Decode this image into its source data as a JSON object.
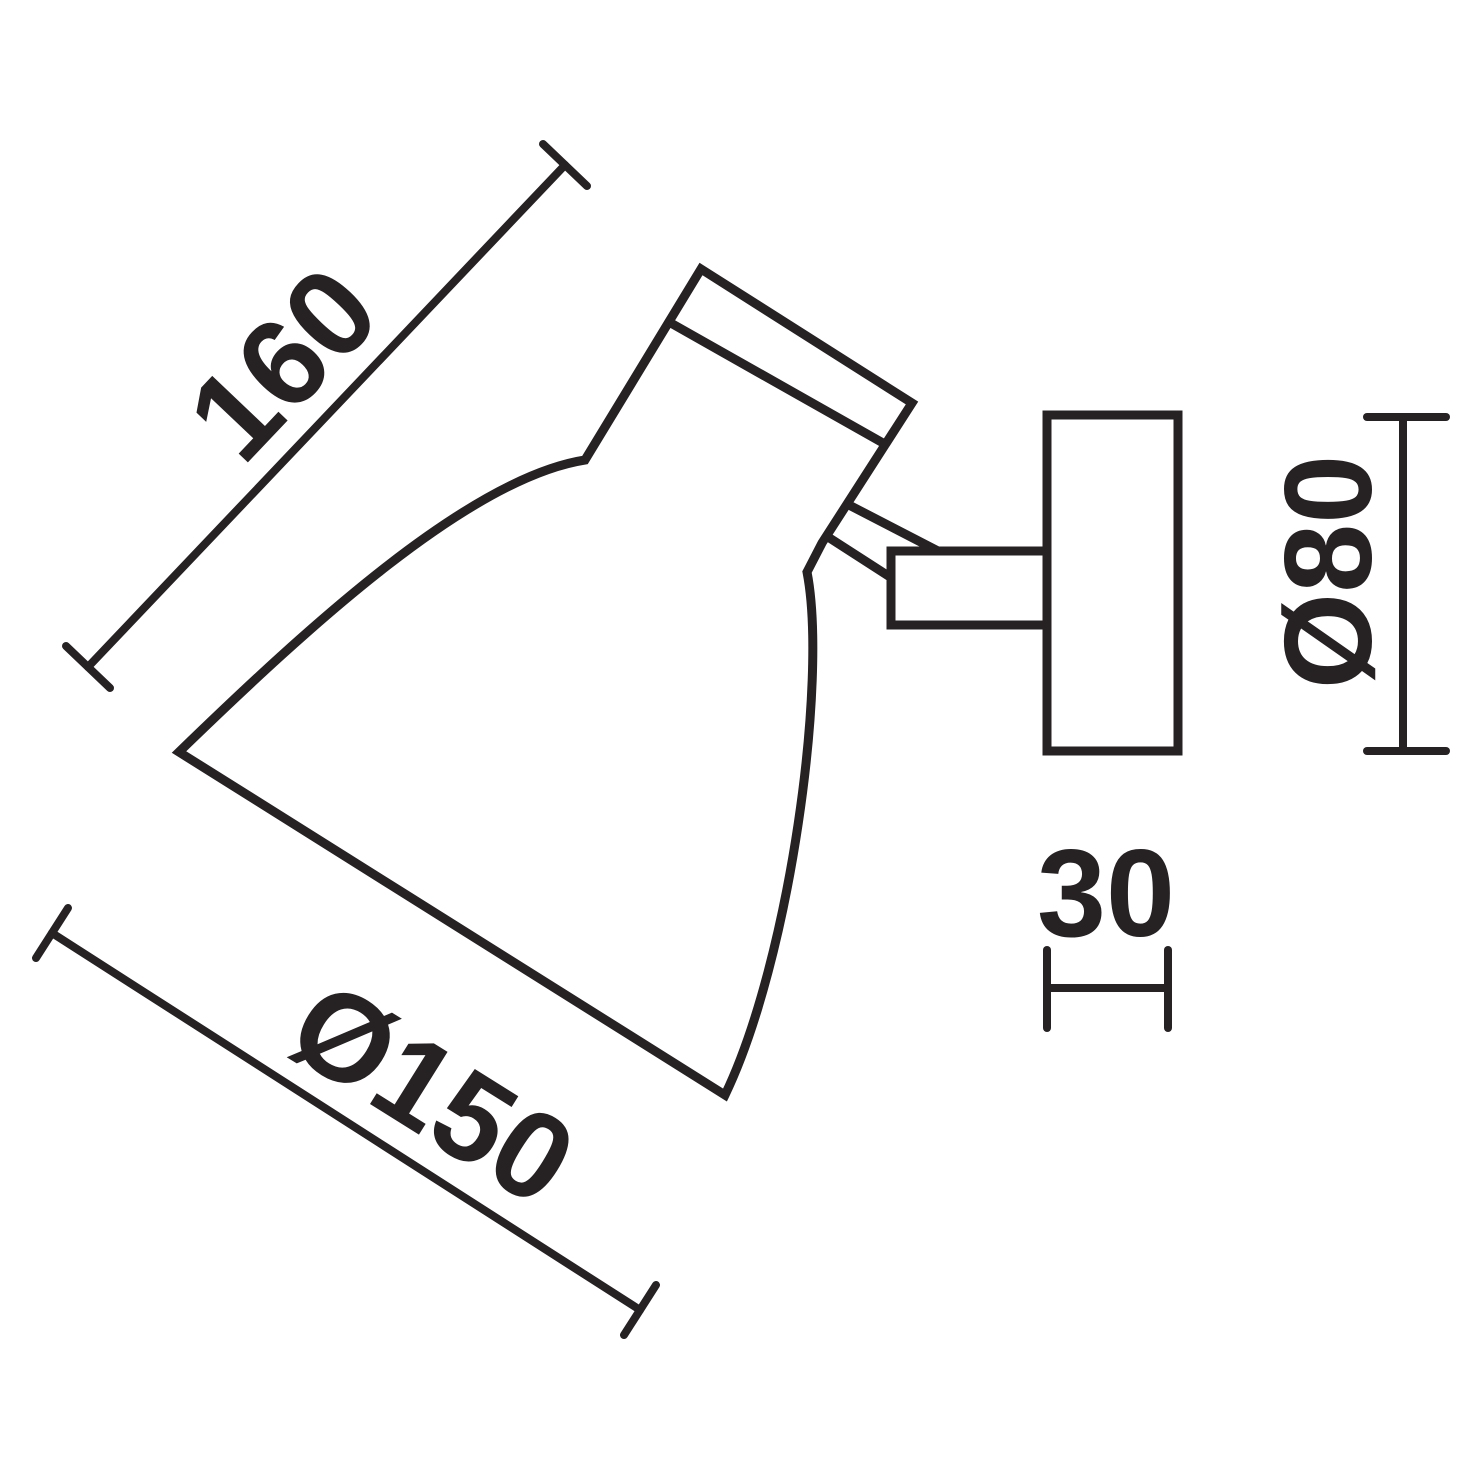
{
  "colors": {
    "ink": "#262122",
    "background": "#ffffff"
  },
  "dimensions": {
    "overall_length": {
      "label": "160"
    },
    "shade_diameter": {
      "label": "Ø150"
    },
    "canopy_diameter": {
      "label": "Ø80"
    },
    "canopy_depth": {
      "label": "30"
    }
  }
}
